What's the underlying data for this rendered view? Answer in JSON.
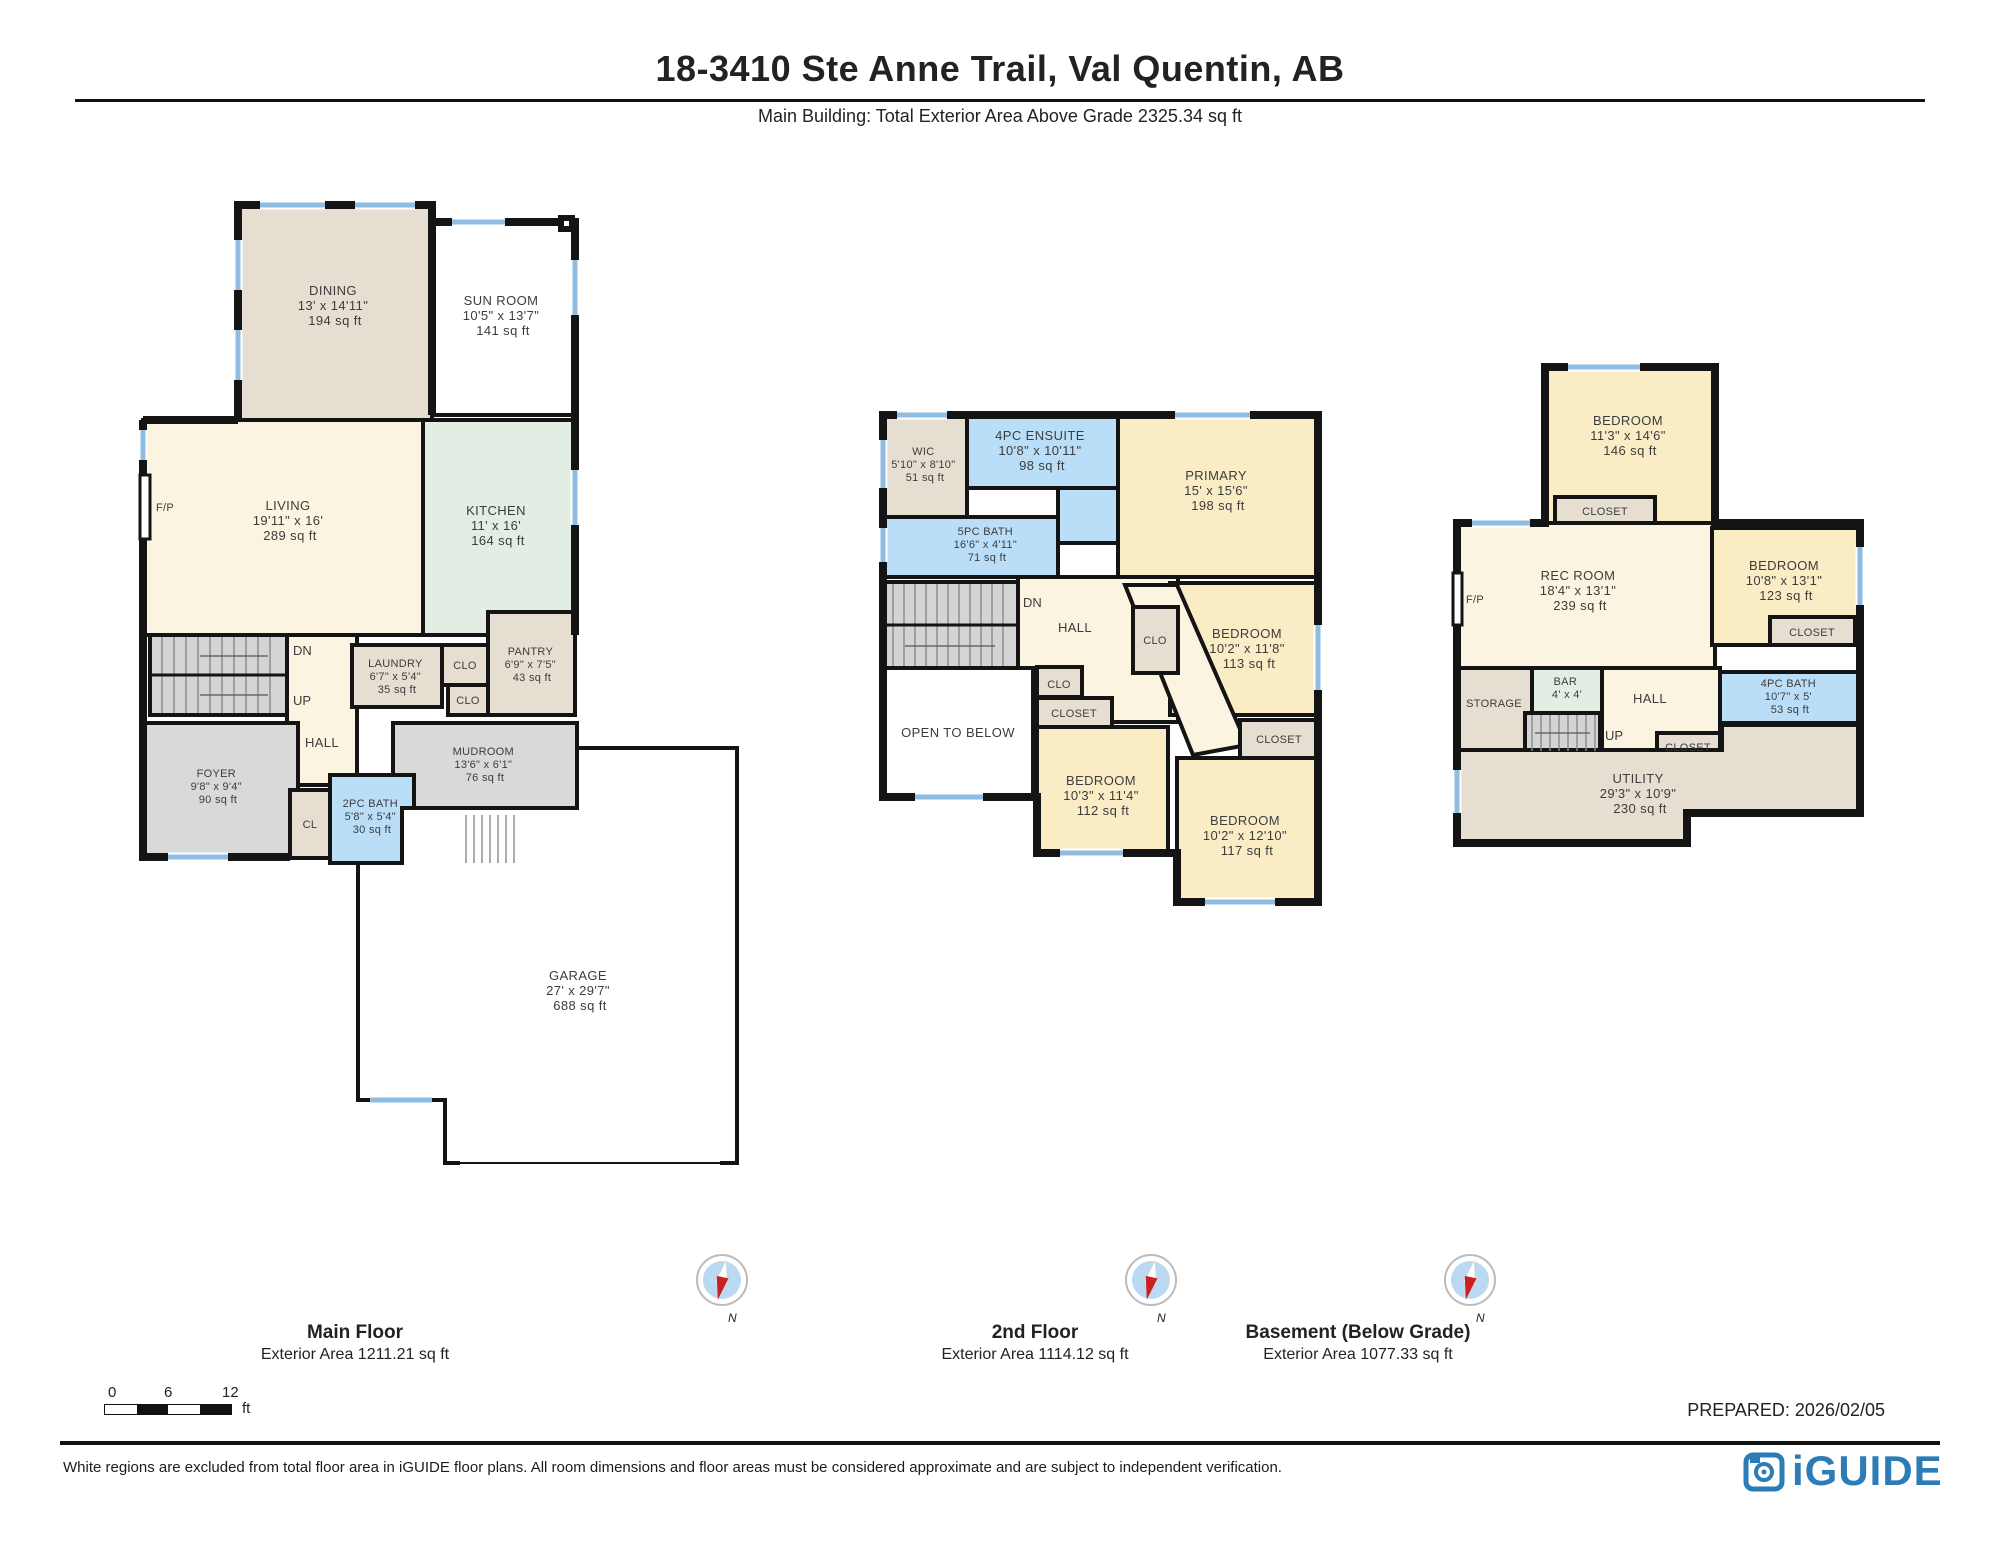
{
  "title": "18-3410 Ste Anne Trail, Val Quentin, AB",
  "subtitle": "Main Building: Total Exterior Area Above Grade 2325.34 sq ft",
  "compass_label": "N",
  "prepared": "PREPARED: 2026/02/05",
  "disclaimer": "White regions are excluded from total floor area in iGUIDE floor plans. All room dimensions and floor areas must be considered approximate and are subject to independent verification.",
  "brand": "iGUIDE",
  "scale_bar": {
    "t0": "0",
    "t6": "6",
    "t12": "12",
    "unit": "ft"
  },
  "stairs_labels": {
    "up": "UP",
    "dn": "DN"
  },
  "floors": [
    {
      "label": "Main Floor",
      "area_label": "Exterior Area 1211.21 sq ft",
      "rooms": [
        {
          "name": "DINING",
          "dims": "13' x 14'11\"",
          "area": "194 sq ft"
        },
        {
          "name": "SUN ROOM",
          "dims": "10'5\" x 13'7\"",
          "area": "141 sq ft"
        },
        {
          "name": "LIVING",
          "dims": "19'11\" x 16'",
          "area": "289 sq ft"
        },
        {
          "name": "KITCHEN",
          "dims": "11' x 16'",
          "area": "164 sq ft"
        },
        {
          "name": "LAUNDRY",
          "dims": "6'7\" x 5'4\"",
          "area": "35 sq ft"
        },
        {
          "name": "PANTRY",
          "dims": "6'9\" x 7'5\"",
          "area": "43 sq ft"
        },
        {
          "name": "MUDROOM",
          "dims": "13'6\" x 6'1\"",
          "area": "76 sq ft"
        },
        {
          "name": "FOYER",
          "dims": "9'8\" x 9'4\"",
          "area": "90 sq ft"
        },
        {
          "name": "2PC BATH",
          "dims": "5'8\" x 5'4\"",
          "area": "30 sq ft"
        },
        {
          "name": "GARAGE",
          "dims": "27' x 29'7\"",
          "area": "688 sq ft"
        },
        {
          "name": "HALL"
        },
        {
          "name": "CLO"
        },
        {
          "name": "CLO"
        },
        {
          "name": "CL"
        },
        {
          "name": "F/P"
        }
      ]
    },
    {
      "label": "2nd Floor",
      "area_label": "Exterior Area 1114.12 sq ft",
      "rooms": [
        {
          "name": "WIC",
          "dims": "5'10\" x 8'10\"",
          "area": "51 sq ft"
        },
        {
          "name": "4PC ENSUITE",
          "dims": "10'8\" x 10'11\"",
          "area": "98 sq ft"
        },
        {
          "name": "PRIMARY",
          "dims": "15' x 15'6\"",
          "area": "198 sq ft"
        },
        {
          "name": "5PC BATH",
          "dims": "16'6\" x 4'11\"",
          "area": "71 sq ft"
        },
        {
          "name": "BEDROOM",
          "dims": "10'2\" x 11'8\"",
          "area": "113 sq ft"
        },
        {
          "name": "BEDROOM",
          "dims": "10'3\" x 11'4\"",
          "area": "112 sq ft"
        },
        {
          "name": "BEDROOM",
          "dims": "10'2\" x 12'10\"",
          "area": "117 sq ft"
        },
        {
          "name": "HALL"
        },
        {
          "name": "OPEN TO BELOW"
        },
        {
          "name": "CLO"
        },
        {
          "name": "CLO"
        },
        {
          "name": "CLOSET"
        },
        {
          "name": "CLOSET"
        }
      ]
    },
    {
      "label": "Basement (Below Grade)",
      "area_label": "Exterior Area 1077.33 sq ft",
      "rooms": [
        {
          "name": "BEDROOM",
          "dims": "11'3\" x 14'6\"",
          "area": "146 sq ft"
        },
        {
          "name": "REC ROOM",
          "dims": "18'4\" x 13'1\"",
          "area": "239 sq ft"
        },
        {
          "name": "BEDROOM",
          "dims": "10'8\" x 13'1\"",
          "area": "123 sq ft"
        },
        {
          "name": "4PC BATH",
          "dims": "10'7\" x 5'",
          "area": "53 sq ft"
        },
        {
          "name": "BAR",
          "dims": "4' x 4'"
        },
        {
          "name": "STORAGE"
        },
        {
          "name": "UTILITY",
          "dims": "29'3\" x 10'9\"",
          "area": "230 sq ft"
        },
        {
          "name": "HALL"
        },
        {
          "name": "CLOSET"
        },
        {
          "name": "CLOSET"
        },
        {
          "name": "CLOSET"
        },
        {
          "name": "F/P"
        }
      ]
    }
  ]
}
